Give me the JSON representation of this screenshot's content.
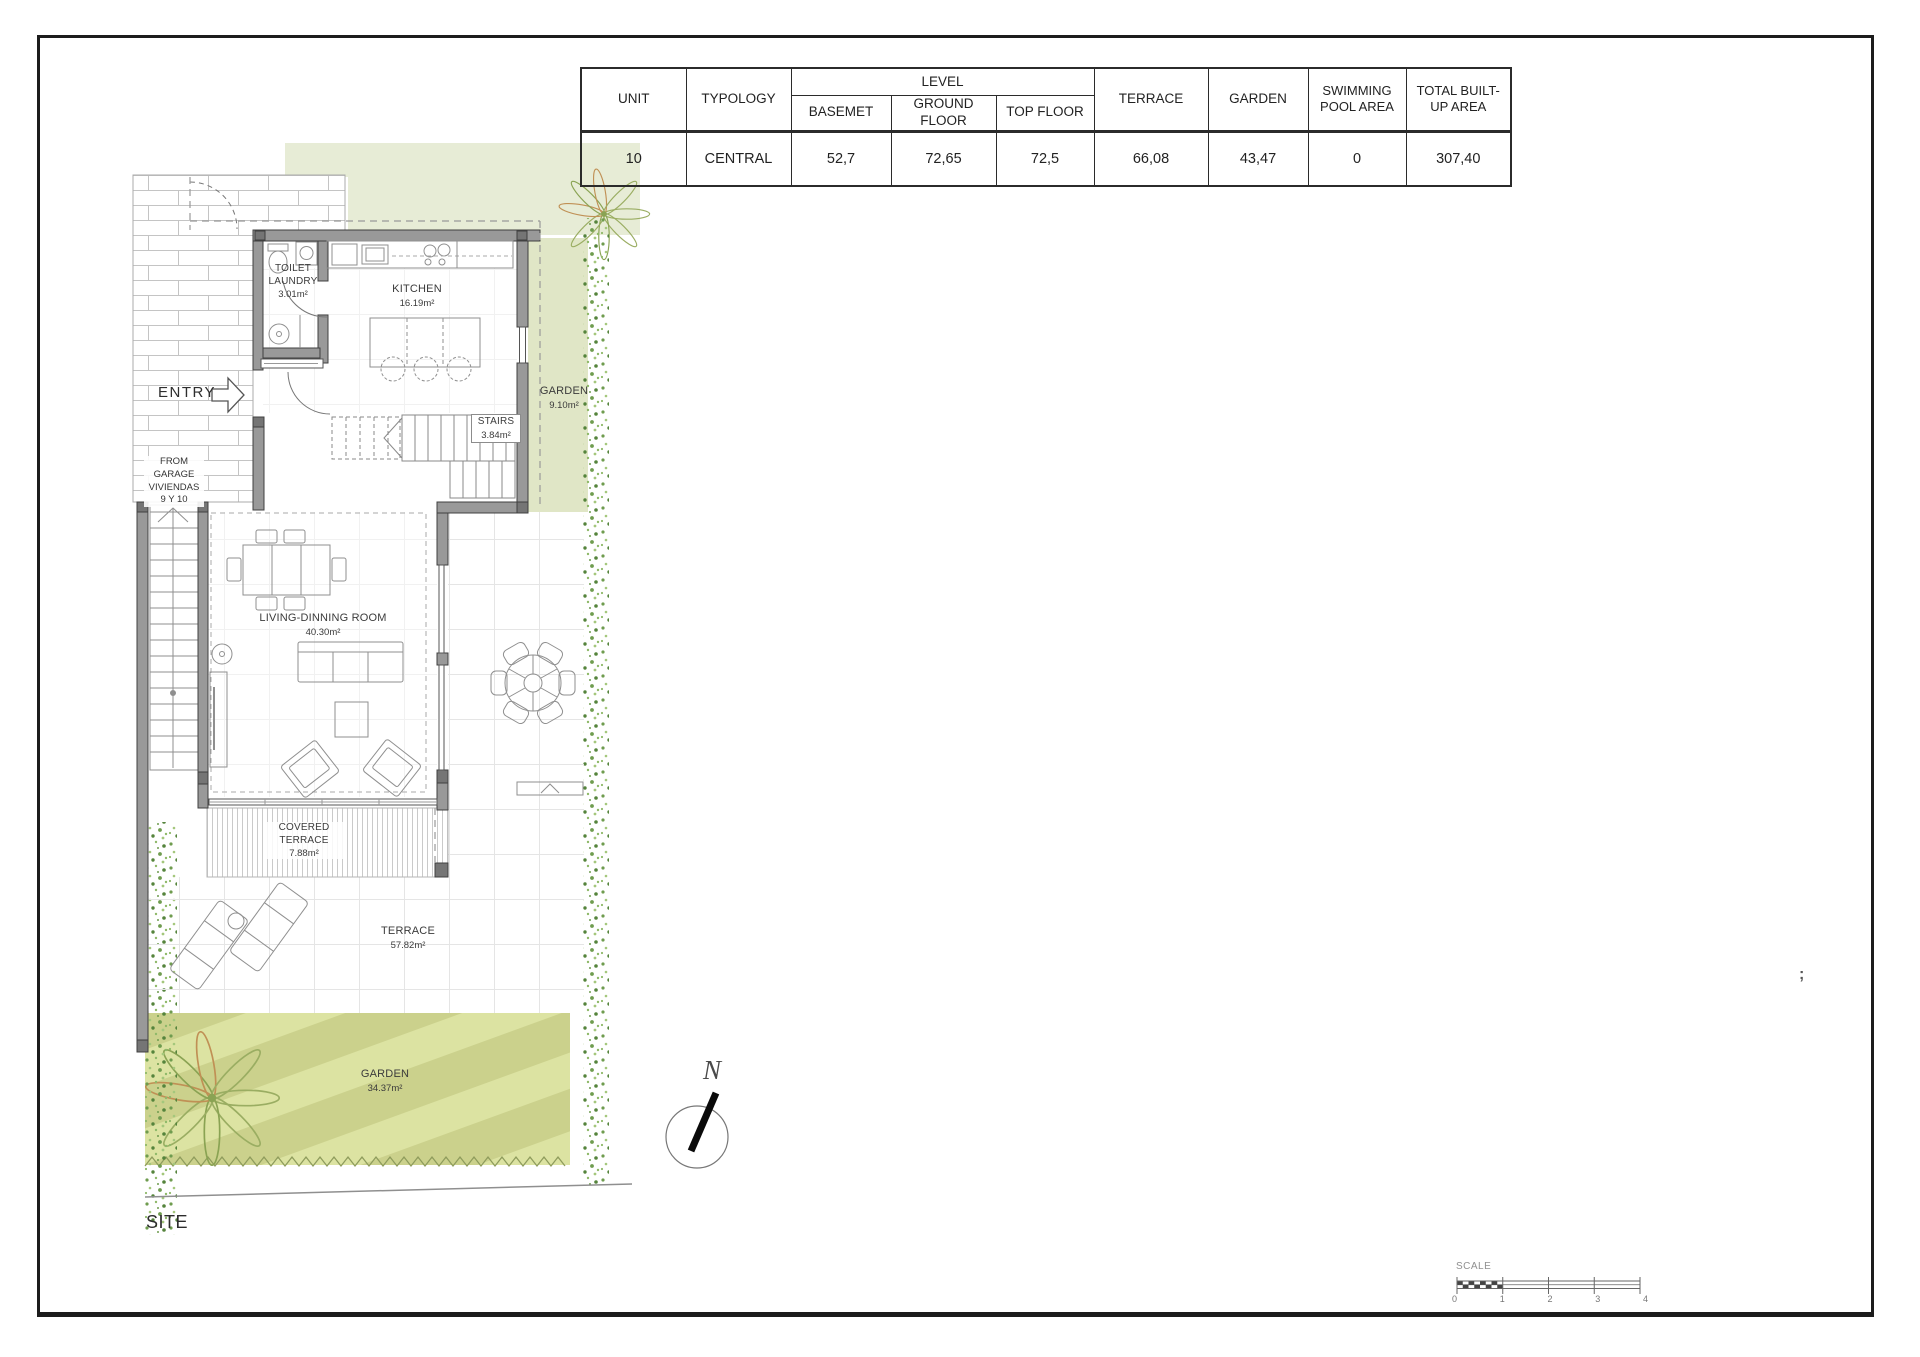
{
  "table": {
    "headers": {
      "unit": "UNIT",
      "typology": "TYPOLOGY",
      "level": "LEVEL",
      "basement": "BASEMET",
      "ground_floor": "GROUND FLOOR",
      "top_floor": "TOP FLOOR",
      "terrace": "TERRACE",
      "garden": "GARDEN",
      "swimming_pool": "SWIMMING POOL AREA",
      "total": "TOTAL BUILT-UP AREA"
    },
    "row": {
      "unit": "10",
      "typology": "CENTRAL",
      "basement": "52,7",
      "ground_floor": "72,65",
      "top_floor": "72,5",
      "terrace": "66,08",
      "garden": "43,47",
      "swimming_pool": "0",
      "total": "307,40"
    }
  },
  "plan": {
    "rooms": {
      "toilet_laundry": {
        "line1": "TOILET",
        "line2": "LAUNDRY",
        "area": "3.01m²"
      },
      "kitchen": {
        "name": "KITCHEN",
        "area": "16.19m²"
      },
      "garden_side": {
        "name": "GARDEN",
        "area": "9.10m²"
      },
      "stairs": {
        "name": "STAIRS",
        "area": "3.84m²"
      },
      "living_dining": {
        "name": "LIVING-DINNING ROOM",
        "area": "40.30m²"
      },
      "covered_terrace": {
        "line1": "COVERED",
        "line2": "TERRACE",
        "area": "7.88m²"
      },
      "terrace": {
        "name": "TERRACE",
        "area": "57.82m²"
      },
      "garden_main": {
        "name": "GARDEN",
        "area": "34.37m²"
      }
    },
    "entry_label": "ENTRY",
    "from_garage": [
      "FROM",
      "GARAGE",
      "VIVIENDAS",
      "9 Y 10"
    ],
    "site_label": "SITE",
    "north_label": "N",
    "stray_mark": ";"
  },
  "scale_bar": {
    "label": "SCALE",
    "ticks": [
      "0",
      "1",
      "2",
      "3",
      "4"
    ]
  },
  "colors": {
    "wall_gray": "#999999",
    "garden_light": "#e3e8cc",
    "garden_stripe_base": "#cbd18c",
    "garden_stripe_light": "#dce3a2",
    "vegetation_green": "#6f9c4f"
  }
}
